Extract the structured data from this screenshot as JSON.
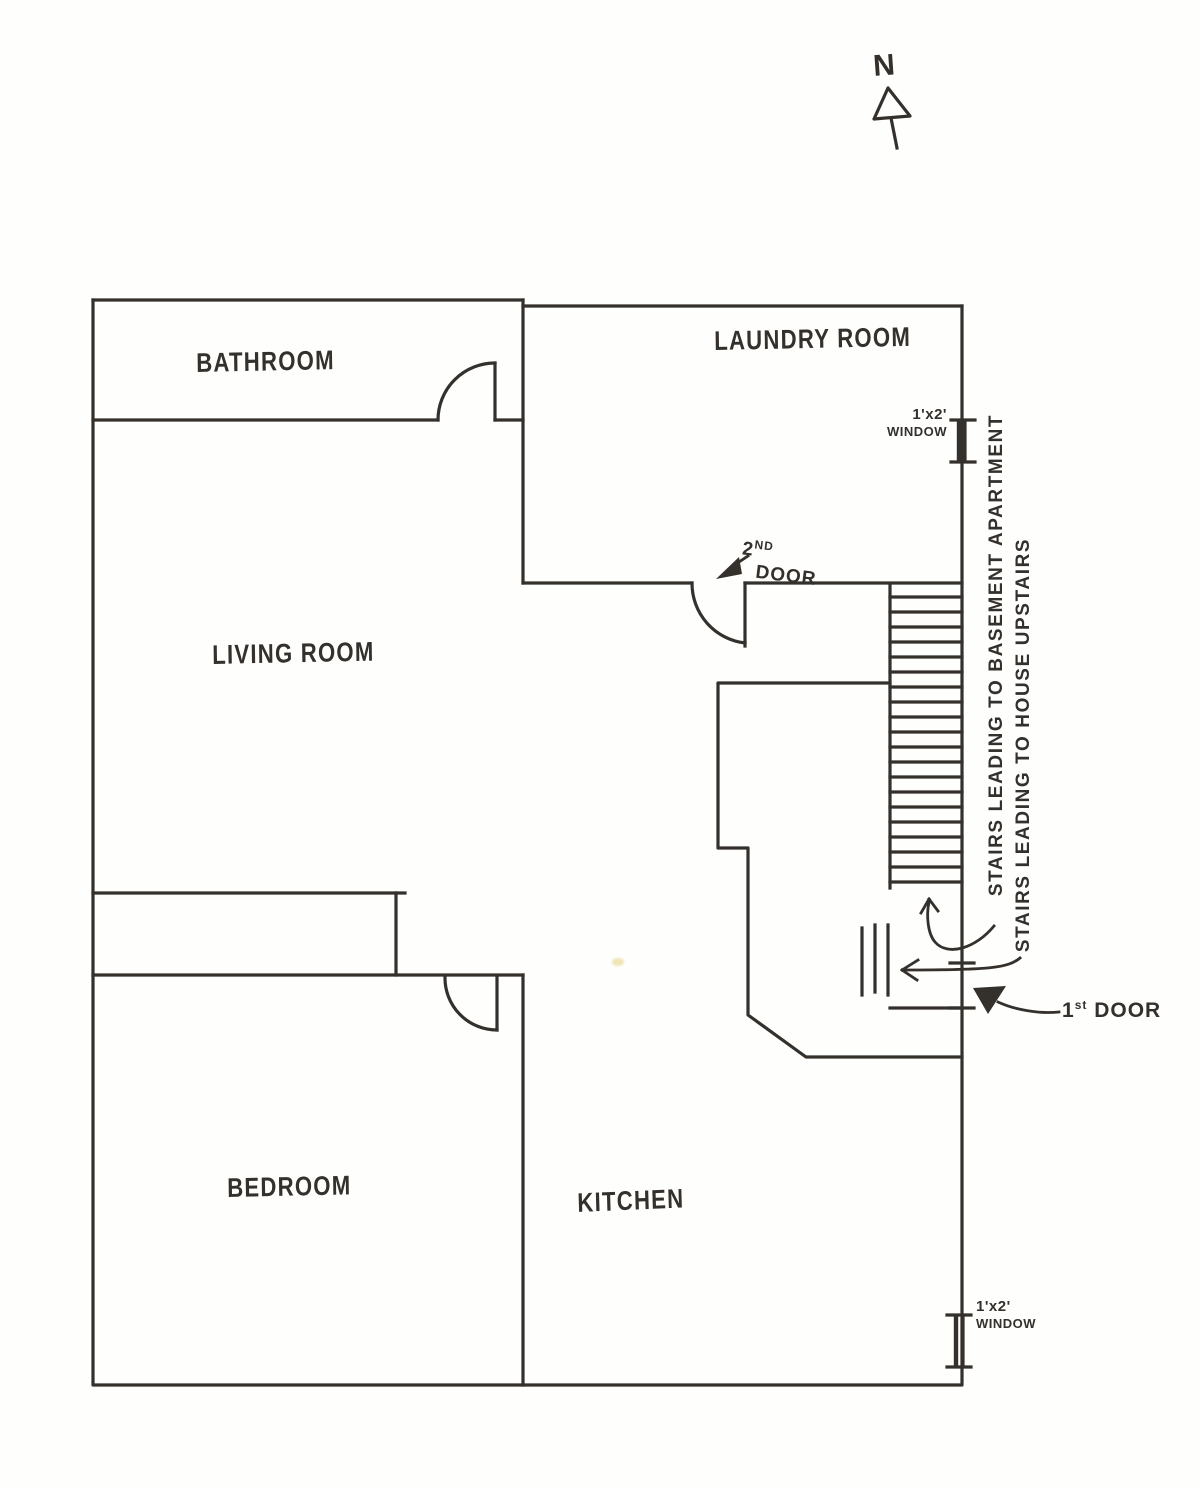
{
  "meta": {
    "ink_color": "#34302c",
    "paper_color": "#fefefd"
  },
  "compass": {
    "label": "N"
  },
  "rooms": {
    "bathroom": {
      "label": "BATHROOM"
    },
    "laundry": {
      "label": "LAUNDRY ROOM"
    },
    "living": {
      "label": "LIVING ROOM"
    },
    "bedroom": {
      "label": "BEDROOM"
    },
    "kitchen": {
      "label": "KITCHEN"
    }
  },
  "doors": {
    "second": {
      "num": "2",
      "sup": "ND",
      "word": "DOOR"
    },
    "first": {
      "num": "1",
      "sup": "st",
      "word": "DOOR"
    }
  },
  "windows": {
    "top": {
      "size": "1'x2'",
      "word": "WINDOW"
    },
    "bottom": {
      "size": "1'x2'",
      "word": "WINDOW"
    }
  },
  "stairs": {
    "to_basement_label": "STAIRS LEADING TO BASEMENT APARTMENT",
    "to_upstairs_label": "STAIRS LEADING TO HOUSE UPSTAIRS",
    "step_count": 20,
    "steps_top_y": 597,
    "steps_bottom_y": 882,
    "rail_left_x": 890,
    "rail_right_x": 962
  }
}
